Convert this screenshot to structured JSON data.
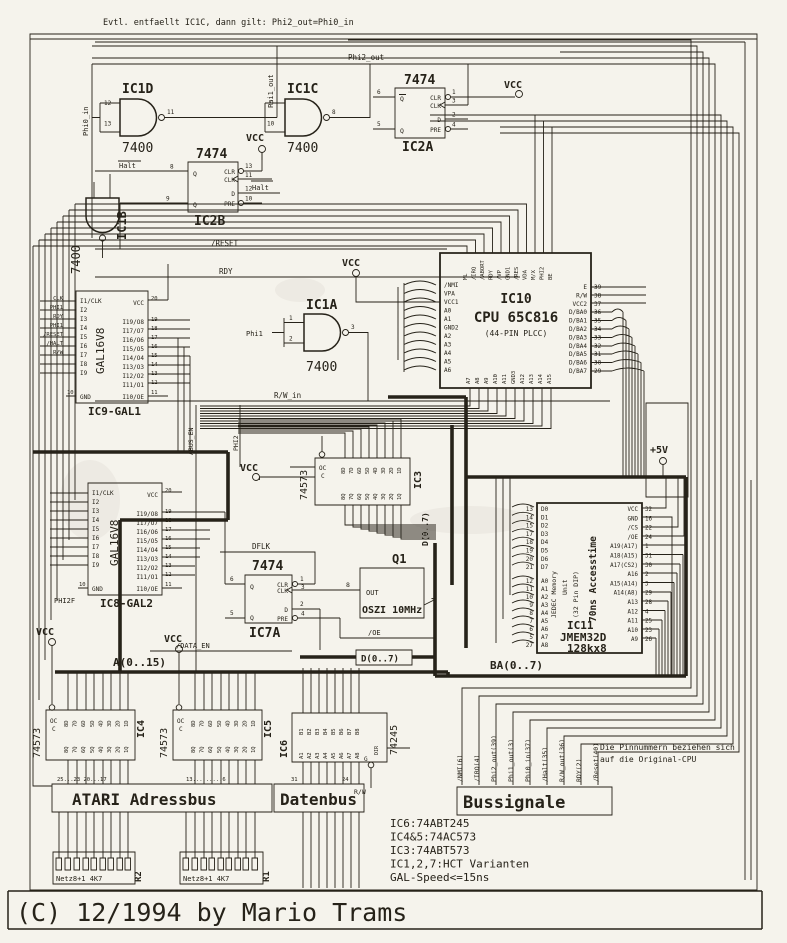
{
  "page": {
    "bg": "#f5f3ec",
    "ink": "#262219"
  },
  "top_note": "Evtl. entfaellt IC1C,  dann gilt: Phi2_out=Phi0_in",
  "copyright": "(C) 12/1994 by Mario Trams",
  "gates": {
    "ic1d": {
      "name": "IC1D",
      "part": "7400",
      "p1": "12",
      "p2": "13",
      "po": "11"
    },
    "ic1c": {
      "name": "IC1C",
      "part": "7400",
      "p1": "9",
      "p2": "10",
      "po": "8"
    },
    "ic1a": {
      "name": "IC1A",
      "part": "7400",
      "p1": "1",
      "p2": "2",
      "po": "3"
    },
    "ic1b": {
      "name": "IC1B",
      "part": "7400"
    }
  },
  "ff": {
    "part": "7474",
    "clr": "CLR",
    "clk": "CLK",
    "d": "D",
    "pre": "PRE",
    "q": "Q",
    "ic2a": {
      "name": "IC2A",
      "l1": "6",
      "l2": "5",
      "r1": "1",
      "r2": "3",
      "r3": "2",
      "r4": "4"
    },
    "ic2b": {
      "name": "IC2B",
      "l1": "8",
      "l2": "9",
      "r1": "13",
      "r2": "11",
      "r3": "12",
      "r4": "10"
    },
    "ic7a": {
      "name": "IC7A",
      "l1": "6",
      "l2": "5",
      "r1": "1",
      "r2": "3",
      "r3": "2",
      "r4": "4"
    }
  },
  "gal": {
    "part": "GAL16V8",
    "vcc": "VCC",
    "gnd": "GND",
    "vcc_pin": "20",
    "gnd_pin": "10",
    "oe": "I10/OE",
    "oe_pin": "11",
    "left_pins": [
      "I1/CLK",
      "I2",
      "I3",
      "I4",
      "I5",
      "I6",
      "I7",
      "I8",
      "I9"
    ],
    "right_pins": [
      "I19/O8",
      "I17/O7",
      "I16/O6",
      "I15/O5",
      "I14/O4",
      "I13/O3",
      "I12/O2",
      "I11/O1"
    ],
    "right_nums": [
      "19",
      "18",
      "17",
      "16",
      "15",
      "14",
      "13",
      "12"
    ],
    "ic9": "IC9-GAL1",
    "ic8": "IC8-GAL2",
    "ic9_inputs": [
      "CLK",
      "PHI1",
      "RDY",
      "PHI1",
      "/RESET",
      "/HALT",
      "R/W"
    ]
  },
  "cpu": {
    "name": "IC10",
    "title": "CPU 65C816",
    "pkg": "(44-PIN PLCC)",
    "top_pins": [
      "ML",
      "/IRQ",
      "/ABORT",
      "RDY",
      "/VP",
      "GND1",
      "/RES",
      "VDA",
      "M/X",
      "PHI2",
      "BE"
    ],
    "left_pins": [
      "/NMI",
      "VPA",
      "VCC1",
      "A0",
      "A1",
      "GND2",
      "A2",
      "A3",
      "A4",
      "A5",
      "A6"
    ],
    "right_pins": [
      "E",
      "R/W",
      "VCC2",
      "D/BA0",
      "D/BA1",
      "D/BA2",
      "D/BA3",
      "D/BA4",
      "D/BA5",
      "D/BA6",
      "D/BA7"
    ],
    "right_nums": [
      "39",
      "38",
      "37",
      "36",
      "35",
      "34",
      "33",
      "32",
      "31",
      "30",
      "29"
    ],
    "bottom_pins": [
      "A7",
      "A8",
      "A9",
      "A10",
      "A11",
      "GND3",
      "A12",
      "A13",
      "A14",
      "A15"
    ]
  },
  "latch": {
    "part": "74573",
    "oc": "OC",
    "c": "C",
    "d_pins": [
      "8D",
      "7D",
      "6D",
      "5D",
      "4D",
      "3D",
      "2D",
      "1D"
    ],
    "q_pins": [
      "8Q",
      "7Q",
      "6Q",
      "5Q",
      "4Q",
      "3Q",
      "2Q",
      "1Q"
    ],
    "ic3": "IC3",
    "ic4": "IC4",
    "ic5": "IC5"
  },
  "buf": {
    "part": "74245",
    "name": "IC6",
    "dir": "DIR",
    "g": "G",
    "rw": "R/W",
    "b_pins": [
      "B1",
      "B2",
      "B3",
      "B4",
      "B5",
      "B6",
      "B7",
      "B8"
    ],
    "a_pins": [
      "A1",
      "A2",
      "A3",
      "A4",
      "A5",
      "A6",
      "A7",
      "A8"
    ]
  },
  "osc": {
    "name": "Q1",
    "label": "OSZI 10MHz",
    "out": "OUT",
    "pin": "8"
  },
  "mem": {
    "name": "IC11",
    "part": "JMEM32D",
    "size": "128kx8",
    "l1": "JEDEC Memory",
    "l2": "Unit",
    "l3": "(32 Pin DIP)",
    "l4": "70ns Accesstime",
    "d_pins": [
      "D0",
      "D1",
      "D2",
      "D3",
      "D4",
      "D5",
      "D6",
      "D7"
    ],
    "d_nums": [
      "13",
      "14",
      "15",
      "17",
      "18",
      "19",
      "20",
      "21"
    ],
    "a_pins": [
      "A0",
      "A1",
      "A2",
      "A3",
      "A4",
      "A5",
      "A6",
      "A7",
      "A8"
    ],
    "a_nums": [
      "12",
      "11",
      "10",
      "9",
      "8",
      "7",
      "6",
      "5",
      "27"
    ],
    "right_pins": [
      "VCC",
      "GND",
      "/CS",
      "/OE",
      "A19(A17)",
      "A18(A15)",
      "A17(CS2)",
      "A16",
      "A15(A14)",
      "A14(A8)",
      "A13",
      "A12",
      "A11",
      "A10",
      "A9"
    ],
    "right_nums": [
      "32",
      "16",
      "22",
      "24",
      "1",
      "31",
      "30",
      "2",
      "3",
      "29",
      "28",
      "4",
      "25",
      "23",
      "26"
    ]
  },
  "buses": {
    "a": "A(0..15)",
    "d": "D(0..7)",
    "dv": "D(0..7)",
    "ba": "BA(0..7)"
  },
  "blocks": {
    "adressbus": "ATARI Adressbus",
    "datenbus": "Datenbus",
    "bussignale": "Bussignale"
  },
  "bus_signals": [
    "/NMI(6)",
    "/IRQ(4)",
    "Phi2_out(39)",
    "Phi1_out(3)",
    "Phi0_in(37)",
    "/Halt(35)",
    "R/W_out(36)",
    "RDY(2)",
    "/Reset(40)"
  ],
  "pin_note": [
    "Die Pinnummern beziehen sich",
    "auf die Original-CPU"
  ],
  "notes": [
    "IC6:74ABT245",
    "IC4&5:74AC573",
    "IC3:74ABT573",
    "IC1,2,7:HCT Varianten",
    "GAL-Speed<=15ns"
  ],
  "rnet": {
    "label": "Netz8+1 4K7",
    "r1": "R1",
    "r2": "R2"
  },
  "power": {
    "vcc": "VCC",
    "p5": "+5V"
  },
  "sig": {
    "phi0_in": "Phi0_in",
    "phi1_out": "Phi1_out",
    "phi2_out": "Phi2_out",
    "halt": "Halt",
    "reset": "/RESET",
    "rdy": "RDY",
    "phi1": "Phi1",
    "rw_in": "R/W_in",
    "abus_en": "ABUS_EN",
    "phi2": "PHI2",
    "phi2f": "PHI2F",
    "dflk": "DFLK",
    "data_en": "/DATA_EN",
    "oe": "/OE",
    "rw": "R/W"
  },
  "bus_nums": {
    "n1": "25...23 20...17",
    "n2": "13.........6",
    "n3": "31",
    "n4": "24"
  }
}
